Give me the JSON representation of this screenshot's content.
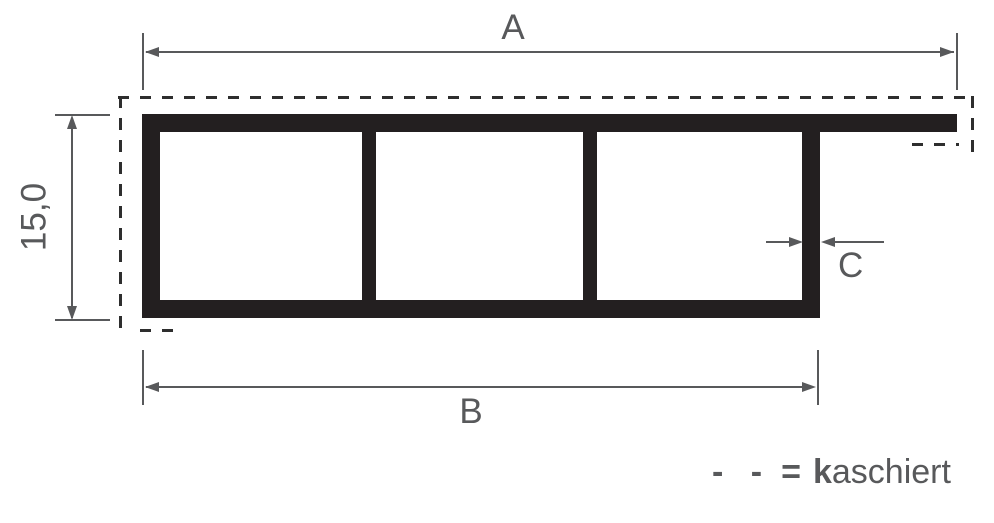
{
  "labels": {
    "dim_top_width": "A",
    "dim_bottom_width": "B",
    "dim_height": "15,0",
    "dim_wall_thickness": "C"
  },
  "legend": {
    "dash_symbol": "- -",
    "equals_sign": "=",
    "word_bold_prefix": "k",
    "word_rest": "aschiert",
    "full_text": "- - = kaschiert"
  },
  "profile": {
    "chamber_count": 3
  },
  "colors": {
    "profile_fill": "#231f20",
    "dimension_gray": "#58595b",
    "laminate_dash": "#2e2e2e",
    "background": "#ffffff"
  }
}
